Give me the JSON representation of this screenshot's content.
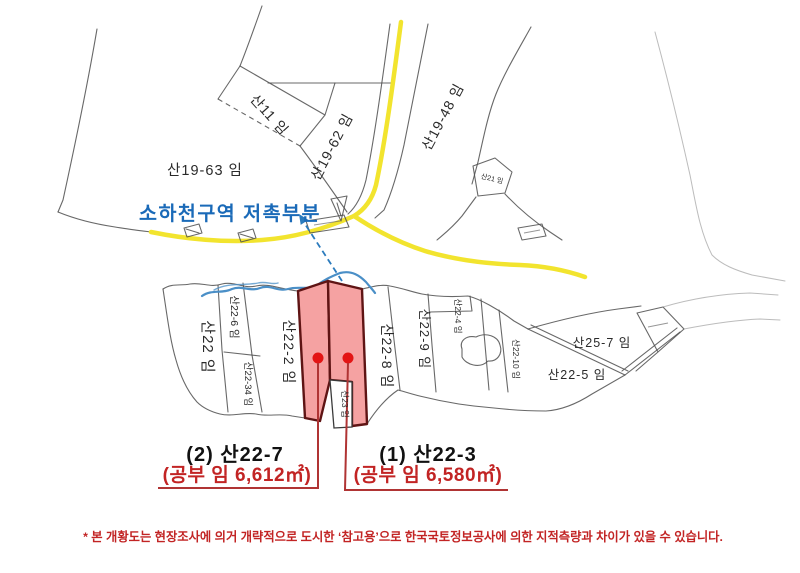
{
  "parcel_labels": {
    "san11": "산11 임",
    "san19_63": "산19-63 임",
    "san19_62": "산19-62 임",
    "san19_48": "산19-48 임",
    "san21": "산21 임",
    "san22": "산22 임",
    "san22_6": "산22-6 임",
    "san22_34": "산22-34 임",
    "san22_2": "산22-2 임",
    "san22_8": "산22-8 임",
    "san22_9": "산22-9 임",
    "san22_4": "산22-4 임",
    "san22_10": "산22-10 임",
    "san25_7": "산25-7 임",
    "san22_5": "산22-5 임",
    "san23": "산23 임"
  },
  "overlay": {
    "stream_zone_label": "소하천구역 저촉부분"
  },
  "annotations": {
    "left": {
      "lot": "(2) 산22-7",
      "area": "(공부 임 6,612㎡)"
    },
    "right": {
      "lot": "(1) 산22-3",
      "area": "(공부 임 6,580㎡)"
    }
  },
  "footnote": "* 본 개황도는 현장조사에 의거 개략적으로 도시한 ‘참고용’으로 한국국토정보공사에 의한 지적측량과 차이가 있을 수 있습니다.",
  "colors": {
    "road_yellow": "#f2e42e",
    "stream_blue": "#4a8fc7",
    "annotation_blue": "#1a6ab8",
    "highlight_fill": "#f5a2a2",
    "highlight_border": "#5f1414",
    "marker_red": "#e31515",
    "leader_red": "#b03434",
    "note_red": "#c22424"
  }
}
